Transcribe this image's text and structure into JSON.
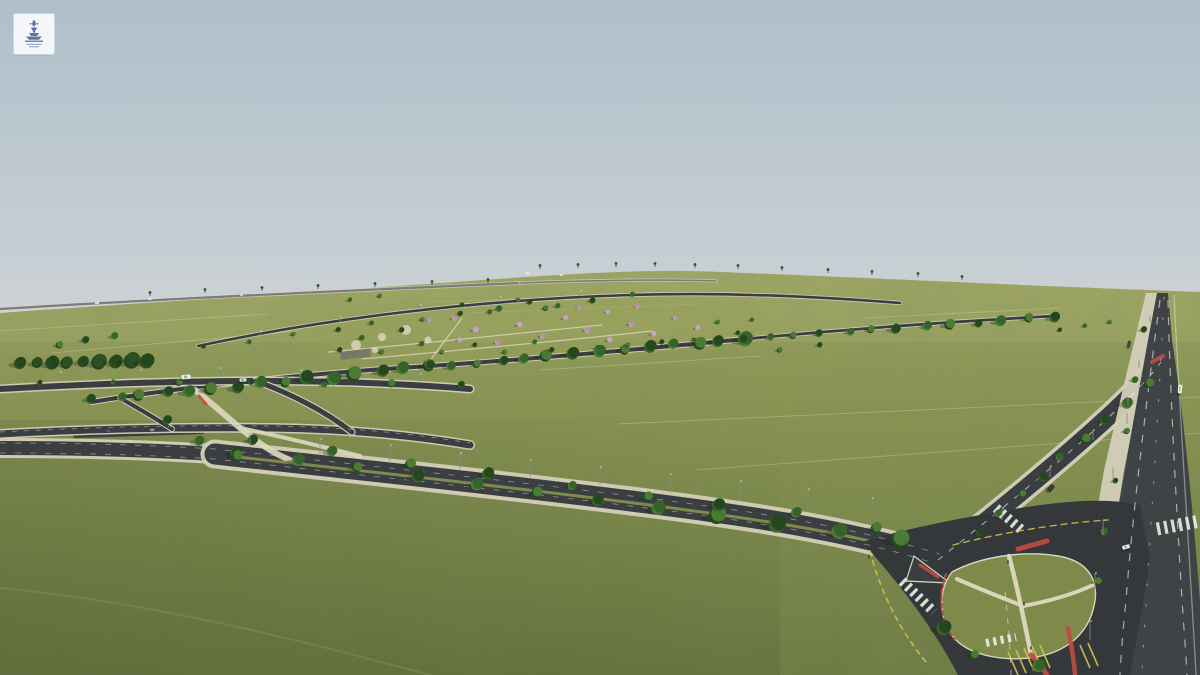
{
  "meta": {
    "title": "Aerial masterplan render",
    "description": "Aerial 3D rendering of a master-planned land development: green subdivided fields, central park with flowering trees, tree-lined boulevard, highway and a large landscaped road junction"
  },
  "logo": {
    "name": "fountain-emblem",
    "bg": "#f4f6f8",
    "fg": "#5b75a9"
  },
  "palette": {
    "sky_top": "#afbfca",
    "sky_bottom": "#ced3d6",
    "grass_far": "#9da565",
    "grass_mid": "#87924f",
    "grass_near": "#6a7740",
    "grass_island": "#7d8a4a",
    "belt_dark": "#2a4f22",
    "belt_mid": "#3a672c",
    "belt_light": "#4d7c35",
    "tree_dark": "#24471e",
    "tree_mid": "#35632a",
    "tree_light": "#4a7a33",
    "pink": "#b98fb6",
    "pink2": "#caa3c6",
    "asphalt": "#3a3e41",
    "asphalt_dark": "#34383b",
    "asphalt_hwy": "#3f4346",
    "sidewalk": "#d4cfb8",
    "path_tan": "#ded8c0",
    "curb": "#dbd6c0",
    "white_mark": "#e9e9e4",
    "yellow": "#d4c54a",
    "red": "#bf4b42",
    "pole": "#87898b",
    "shadow": "#1c2912",
    "distant_road": "#7a7d7f"
  },
  "scene": {
    "sky": {
      "h": 332
    },
    "terrain": {
      "d": "M0,313 C140,303 300,293 470,281 C580,273 650,269 720,272 C850,277 1030,286 1200,292 L1200,675 L0,675 Z"
    },
    "distant_roads": [
      {
        "d": "M0,309 C160,299 340,291 520,283",
        "w": 2.2
      },
      {
        "d": "M520,283 C600,280 660,279 716,281",
        "w": 1.6
      }
    ],
    "distant_buildings": [
      [
        525,
        272,
        4,
        2.5
      ],
      [
        560,
        274,
        3,
        2
      ],
      [
        148,
        298,
        3.5,
        2
      ],
      [
        240,
        294,
        3,
        1.8
      ],
      [
        95,
        302,
        4,
        2
      ]
    ],
    "plot_lines": [
      "M0,331 L268,314",
      "M52,353 L298,331",
      "M425,302 L652,294",
      "M468,313 L700,304",
      "M618,424 L1200,397",
      "M695,470 L1200,433",
      "M540,370 L760,356",
      "M865,318 L1060,308"
    ],
    "trails": [
      "M0,588 C150,602 300,640 430,675"
    ],
    "park": {
      "ground": "M298,318 C370,302 510,291 635,294 C735,297 782,308 762,328 C728,352 575,364 450,364 C365,362 300,346 298,318 Z",
      "paths": [
        "M328,352 C420,344 520,333 602,325",
        "M362,359 C452,351 562,341 652,331",
        "M430,361 C440,346 452,332 462,318"
      ],
      "spots": [
        [
          356,
          345,
          5
        ],
        [
          382,
          337,
          4
        ],
        [
          406,
          330,
          5
        ],
        [
          428,
          340,
          3.5
        ],
        [
          375,
          350,
          3
        ]
      ],
      "parking": {
        "x": 340,
        "y": 352,
        "w": 30,
        "h": 8,
        "rot": -7
      }
    },
    "roads": [
      {
        "d": "M198,346 C320,320 470,300 630,295 C720,292 810,296 900,303",
        "w": 2.6,
        "ew": 4.2
      },
      {
        "d": "M92,402 C200,384 330,372 430,366 C560,357 660,347 745,339",
        "w": 4,
        "ew": 6
      },
      {
        "d": "M745,339 C850,329 960,321 1055,316",
        "w": 2.8,
        "ew": 4.4
      },
      {
        "d": "M0,389 C90,384 180,381 258,381 C340,381 410,384 470,389",
        "w": 6,
        "ew": 9
      },
      {
        "d": "M0,434 C90,429 185,427 272,428 C350,429 415,436 470,445",
        "w": 7,
        "ew": 10
      },
      {
        "d": "M256,381 C292,394 326,412 352,432",
        "w": 5,
        "ew": 7.5
      },
      {
        "d": "M120,398 C138,408 158,420 172,429",
        "w": 4,
        "ew": 6
      },
      {
        "d": "M0,448 C80,448 150,450 215,454",
        "w": 14,
        "ew": 20
      },
      {
        "d": "M215,454 C380,472 540,489 670,506 C770,519 850,532 945,559",
        "w": 21,
        "ew": 29
      },
      {
        "d": "M935,562 C995,514 1058,463 1108,417 C1133,394 1149,377 1161,361",
        "w": 18,
        "ew": 25
      },
      {
        "d": "M1004,588 C1008,620 1011,648 1012,675",
        "w": 30,
        "ew": 38
      }
    ],
    "aprons": [
      "M70,427 L200,424 L204,434 L74,438 Z"
    ],
    "tan_paths": [
      {
        "d": "M195,390 C210,402 225,415 240,428 C255,440 270,452 290,460",
        "w": 6
      },
      {
        "d": "M240,428 C280,436 320,446 360,456",
        "w": 4
      }
    ],
    "tan_reds": [
      {
        "d": "M199,396 L206,404",
        "w": 3
      }
    ],
    "median": {
      "d": "M238,457 C390,474 545,491 672,508 C768,521 845,533 905,550",
      "w": 3
    },
    "highway": {
      "side": "M1146,293 L1125,380 L1104,470 L1089,560 L1082,620 L1079,675 L1100,675 L1103,620 L1110,560 L1124,470 L1142,380 L1160,293 Z",
      "main": "M1157,293 C1144,360 1130,440 1118,510 C1108,570 1100,620 1097,675 L1205,675 C1198,560 1186,430 1172,340 L1168,293 Z"
    },
    "intersection": {
      "blob": "M862,542 C900,530 960,518 1020,508 C1070,500 1110,498 1140,505 L1150,560 L1140,620 L1130,675 L958,675 C940,640 910,595 862,542 Z",
      "island": "M952,572 C980,557 1022,550 1058,556 C1088,561 1100,580 1094,606 C1088,634 1066,652 1036,657 C1006,662 972,656 956,640 C940,624 936,592 952,572 Z",
      "island_paths": [
        {
          "d": "M1009,556 C1016,582 1023,614 1031,655",
          "w": 4.5
        },
        {
          "d": "M1023,606 C1000,597 977,588 957,579",
          "w": 4
        },
        {
          "d": "M1023,606 C1050,601 1074,594 1093,585",
          "w": 4
        }
      ],
      "splitter": "M914,556 L950,583 L906,581 Z",
      "reds": [
        {
          "d": "M1031,655 C1038,662 1043,668 1047,675",
          "w": 5
        },
        {
          "d": "M1018,549 L1047,541",
          "w": 5
        },
        {
          "d": "M946,574 C938,596 940,620 955,640",
          "w": 2,
          "dash": "4 3.5"
        },
        {
          "d": "M1068,628 C1072,648 1074,661 1075,675",
          "w": 4.5
        },
        {
          "d": "M1152,362 L1163,356",
          "w": 4
        },
        {
          "d": "M920,565 L938,577",
          "w": 3
        }
      ],
      "crosswalks": [
        {
          "d": "M902,581 L934,612",
          "w": 10
        },
        {
          "d": "M996,508 L1024,532",
          "w": 10
        },
        {
          "d": "M1157,529 L1200,521",
          "w": 13
        },
        {
          "d": "M986,643 L1016,637",
          "w": 8
        }
      ],
      "yellow_arcs": [
        {
          "d": "M870,551 C880,590 898,628 926,662",
          "w": 1.6,
          "dash": "5 5"
        },
        {
          "d": "M953,545 C1000,533 1060,523 1108,520",
          "w": 1.4,
          "dash": "6 5"
        }
      ],
      "hatches": [
        "M1008,652 L1018,675",
        "M1016,650 L1026,673",
        "M1024,648 L1034,671",
        "M1032,646 L1042,669",
        "M1040,645 L1050,668",
        "M1080,645 L1090,668",
        "M1088,643 L1098,666"
      ]
    },
    "dashes": [
      {
        "d": "M0,443 C80,443 150,445 215,449 C380,467 540,484 670,501 C770,514 850,527 940,554",
        "w": 0.8,
        "dash": "6 9",
        "op": 0.5
      },
      {
        "d": "M0,453 C80,453 150,455 215,459 C380,477 540,494 670,511 C770,524 850,537 930,562",
        "w": 0.8,
        "dash": "6 9",
        "op": 0.5
      },
      {
        "d": "M938,560 C998,512 1060,462 1110,416 C1134,394 1150,377 1161,362",
        "w": 1,
        "dash": "6 8",
        "op": 0.7
      },
      {
        "d": "M1160,300 C1148,390 1134,500 1126,600 C1123,630 1121,655 1120,675",
        "w": 1.2,
        "dash": "8 9",
        "op": 0.65
      },
      {
        "d": "M1168,300 C1170,390 1176,500 1182,600 C1184,630 1186,655 1187,675",
        "w": 1.2,
        "dash": "8 9",
        "op": 0.65
      },
      {
        "d": "M1164,297 C1160,380 1154,480 1148,570 C1145,620 1143,650 1142,675",
        "w": 1.1,
        "dash": "2.5 18",
        "op": 0.5
      },
      {
        "d": "M1174,295 C1180,420 1190,560 1196,675",
        "w": 1.3,
        "dash": "0",
        "op": 0.45
      },
      {
        "d": "M1005,592 C1008,620 1010,645 1011,675",
        "w": 1,
        "dash": "6 7",
        "op": 0.6
      },
      {
        "d": "M0,432 C90,427 185,425 272,426 C350,427 415,434 470,443",
        "w": 0.8,
        "dash": "5 7",
        "op": 0.5
      }
    ],
    "tree_rows": [
      {
        "a": [
          94,
          401
        ],
        "b": [
          430,
          367
        ],
        "n": 15,
        "r0": 5.5,
        "r1": 7.5,
        "j": 5
      },
      {
        "a": [
          430,
          367
        ],
        "b": [
          745,
          339
        ],
        "n": 14,
        "r0": 5,
        "r1": 7,
        "j": 5
      },
      {
        "a": [
          745,
          339
        ],
        "b": [
          1052,
          317
        ],
        "n": 13,
        "r0": 4,
        "r1": 5.5,
        "j": 4
      },
      {
        "a": [
          205,
          344
        ],
        "b": [
          630,
          297
        ],
        "n": 11,
        "r0": 2.5,
        "r1": 3.5,
        "j": 7
      },
      {
        "a": [
          238,
          452
        ],
        "b": [
          900,
          540
        ],
        "n": 12,
        "r0": 6,
        "r1": 9,
        "j": 2
      },
      {
        "a": [
          255,
          440
        ],
        "b": [
          880,
          526
        ],
        "n": 9,
        "r0": 5,
        "r1": 6.5,
        "j": 8
      },
      {
        "a": [
          978,
          532
        ],
        "b": [
          1148,
          384
        ],
        "n": 9,
        "r0": 4,
        "r1": 5.5,
        "j": 3
      },
      {
        "a": [
          22,
          363
        ],
        "b": [
          148,
          361
        ],
        "n": 9,
        "r0": 6,
        "r1": 8,
        "j": 2,
        "pal": [
          "tree_dark",
          "belt_dark"
        ]
      },
      {
        "a": [
          1146,
          330
        ],
        "b": [
          1097,
          582
        ],
        "n": 6,
        "r0": 3,
        "r1": 4,
        "j": 2
      },
      {
        "a": [
          40,
          382
        ],
        "b": [
          460,
          385
        ],
        "n": 7,
        "r0": 3,
        "r1": 4,
        "j": 6
      }
    ],
    "singles_green": [
      [
        945,
        628,
        8
      ],
      [
        1040,
        666,
        7
      ],
      [
        975,
        655,
        5
      ],
      [
        168,
        420,
        5
      ],
      [
        200,
        441,
        5.5
      ],
      [
        238,
        456,
        6
      ],
      [
        530,
        302,
        3
      ],
      [
        558,
        306,
        3
      ],
      [
        60,
        345,
        4
      ],
      [
        86,
        340,
        4
      ],
      [
        115,
        336,
        4
      ],
      [
        780,
        350,
        3
      ],
      [
        820,
        345,
        3
      ],
      [
        350,
        300,
        2.5
      ],
      [
        380,
        296,
        2.5
      ],
      [
        1060,
        330,
        2.5
      ],
      [
        1085,
        326,
        2.5
      ],
      [
        1110,
        322,
        2.5
      ]
    ],
    "park_green": [
      [
        340,
        350,
        3
      ],
      [
        362,
        338,
        3.2
      ],
      [
        382,
        352,
        2.8
      ],
      [
        402,
        330,
        3
      ],
      [
        422,
        344,
        3
      ],
      [
        442,
        352,
        2.6
      ],
      [
        462,
        305,
        2.6
      ],
      [
        490,
        312,
        2.8
      ],
      [
        518,
        300,
        2.6
      ],
      [
        552,
        350,
        3
      ],
      [
        598,
        348,
        3
      ],
      [
        628,
        345,
        2.8
      ],
      [
        662,
        342,
        2.8
      ],
      [
        694,
        340,
        2.6
      ],
      [
        718,
        322,
        2.6
      ],
      [
        738,
        333,
        2.6
      ],
      [
        752,
        320,
        2.4
      ],
      [
        505,
        352,
        2.8
      ],
      [
        475,
        345,
        2.6
      ],
      [
        535,
        342,
        2.6
      ]
    ],
    "pinks": [
      [
        455,
        318,
        3
      ],
      [
        476,
        330,
        3.4
      ],
      [
        498,
        342,
        3
      ],
      [
        520,
        325,
        3.2
      ],
      [
        543,
        336,
        3
      ],
      [
        566,
        318,
        3
      ],
      [
        588,
        330,
        3.4
      ],
      [
        610,
        340,
        3
      ],
      [
        632,
        324,
        3.2
      ],
      [
        654,
        334,
        3
      ],
      [
        676,
        318,
        2.8
      ],
      [
        698,
        328,
        3
      ],
      [
        580,
        308,
        2.6
      ],
      [
        608,
        312,
        2.6
      ],
      [
        638,
        306,
        2.6
      ],
      [
        460,
        340,
        2.8
      ],
      [
        430,
        320,
        2.6
      ]
    ],
    "palms": [
      [
        540,
        269
      ],
      [
        578,
        268
      ],
      [
        616,
        267
      ],
      [
        655,
        267
      ],
      [
        695,
        268
      ],
      [
        738,
        269
      ],
      [
        782,
        271
      ],
      [
        828,
        273
      ],
      [
        872,
        275
      ],
      [
        918,
        277
      ],
      [
        962,
        280
      ],
      [
        150,
        296
      ],
      [
        205,
        293
      ],
      [
        262,
        291
      ],
      [
        318,
        289
      ],
      [
        375,
        287
      ],
      [
        432,
        285
      ],
      [
        488,
        283
      ]
    ],
    "poles": [
      [
        250,
        447,
        14
      ],
      [
        320,
        454,
        15
      ],
      [
        390,
        461,
        16
      ],
      [
        460,
        469,
        16
      ],
      [
        530,
        477,
        17
      ],
      [
        600,
        485,
        18
      ],
      [
        670,
        493,
        19
      ],
      [
        740,
        501,
        20
      ],
      [
        808,
        510,
        21
      ],
      [
        872,
        520,
        22
      ],
      [
        1150,
        322,
        7
      ],
      [
        1139,
        368,
        9
      ],
      [
        1127,
        424,
        11
      ],
      [
        1113,
        480,
        13
      ],
      [
        1103,
        535,
        15
      ],
      [
        1095,
        590,
        17
      ],
      [
        1090,
        640,
        19
      ],
      [
        1002,
        520,
        12
      ],
      [
        1050,
        477,
        11
      ],
      [
        1093,
        440,
        10
      ],
      [
        1128,
        406,
        9
      ],
      [
        60,
        379,
        7
      ],
      [
        140,
        377,
        7
      ],
      [
        220,
        376,
        8
      ],
      [
        300,
        378,
        8
      ],
      [
        420,
        382,
        8
      ],
      [
        260,
        336,
        5
      ],
      [
        340,
        322,
        5
      ],
      [
        420,
        310,
        5
      ],
      [
        500,
        302,
        5
      ],
      [
        580,
        296,
        5
      ]
    ],
    "vehicles": [
      {
        "x": 186,
        "y": 377,
        "w": 9,
        "h": 4.5,
        "r": -4,
        "c": "#e9e9e7"
      },
      {
        "x": 243,
        "y": 380,
        "w": 7,
        "h": 3.5,
        "r": -3,
        "c": "#d8d8d4"
      },
      {
        "x": 1126,
        "y": 547,
        "w": 7.5,
        "h": 4,
        "r": -16,
        "c": "#f1f1ef"
      },
      {
        "x": 1180,
        "y": 389,
        "w": 4,
        "h": 8.5,
        "r": 6,
        "c": "#f3f3f1"
      },
      {
        "x": 1129,
        "y": 344,
        "w": 3.2,
        "h": 6.5,
        "r": 10,
        "c": "#3c3e40"
      },
      {
        "x": 1051,
        "y": 488,
        "w": 4.5,
        "h": 7.5,
        "r": 40,
        "c": "#303335"
      },
      {
        "x": 108,
        "y": 431,
        "w": 4.5,
        "h": 2.6,
        "r": -2,
        "c": "#5a5c5e"
      },
      {
        "x": 152,
        "y": 430,
        "w": 4.5,
        "h": 2.6,
        "r": -2,
        "c": "#9a9c9e"
      }
    ],
    "pedestrians": [
      [
        1008,
        562
      ],
      [
        1024,
        604
      ],
      [
        1031,
        648
      ],
      [
        1091,
        521
      ],
      [
        1097,
        517
      ],
      [
        903,
        589
      ],
      [
        869,
        557
      ]
    ]
  }
}
